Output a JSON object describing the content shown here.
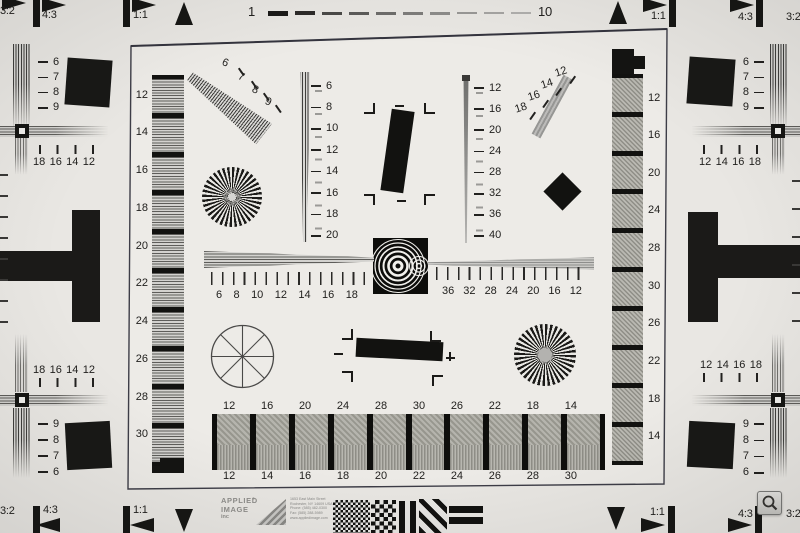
{
  "colors": {
    "paper": "#e9e7e3",
    "paper_inner": "#edebe7",
    "ink": "#1b1a18",
    "frame": "#3d3d47"
  },
  "markers": {
    "tl": [
      "3:2",
      "4:3",
      "1:1"
    ],
    "tr": [
      "1:1",
      "4:3",
      "3:2"
    ],
    "bl": [
      "3:2",
      "4:3",
      "1:1"
    ],
    "br": [
      "1:1",
      "4:3",
      "3:2"
    ]
  },
  "top_scale": {
    "start": "1",
    "end": "10"
  },
  "corner_tl": {
    "side": [
      "6",
      "7",
      "8",
      "9"
    ],
    "row": [
      "18",
      "16",
      "14",
      "12"
    ]
  },
  "corner_tr": {
    "side": [
      "6",
      "7",
      "8",
      "9"
    ],
    "row": [
      "12",
      "14",
      "16",
      "18"
    ]
  },
  "corner_bl": {
    "side": [
      "9",
      "8",
      "7",
      "6"
    ],
    "row": [
      "18",
      "16",
      "14",
      "12"
    ]
  },
  "corner_br": {
    "side": [
      "9",
      "8",
      "7",
      "6"
    ],
    "row": [
      "12",
      "14",
      "16",
      "18"
    ]
  },
  "left_column_labels": [
    "12",
    "14",
    "16",
    "18",
    "20",
    "22",
    "24",
    "26",
    "28",
    "30"
  ],
  "right_column_labels": [
    "12",
    "16",
    "20",
    "24",
    "28",
    "30",
    "26",
    "22",
    "18",
    "14"
  ],
  "diag_tl_labels": [
    "6",
    "7",
    "8",
    "9"
  ],
  "diag_tr_labels": [
    "12",
    "14",
    "16",
    "18"
  ],
  "center_vertical_scale": [
    "6",
    "8",
    "10",
    "12",
    "14",
    "16",
    "18",
    "20"
  ],
  "right_vertical_scale": [
    "12",
    "16",
    "20",
    "24",
    "28",
    "32",
    "36",
    "40"
  ],
  "horizontal_scale_left": [
    "6",
    "8",
    "10",
    "12",
    "14",
    "16",
    "18"
  ],
  "horizontal_scale_right": [
    "36",
    "32",
    "28",
    "24",
    "20",
    "16",
    "12"
  ],
  "grayscale_labels": {
    "top": [
      "12",
      "16",
      "20",
      "24",
      "28",
      "30",
      "26",
      "22",
      "18",
      "14"
    ],
    "bottom": [
      "12",
      "14",
      "16",
      "18",
      "20",
      "22",
      "24",
      "26",
      "28",
      "30"
    ]
  },
  "logo": {
    "line1": "APPLIED",
    "line2": "IMAGE",
    "line3": "inc",
    "reg": "®",
    "address": [
      "1653 East Main Street",
      "Rochester, NY 14609 USA",
      "Phone: (585) 482-0300",
      "Fax: (585) 288-5989",
      "www.appliedimage.com"
    ]
  },
  "icons": {
    "magnifier": "magnifying-glass"
  }
}
